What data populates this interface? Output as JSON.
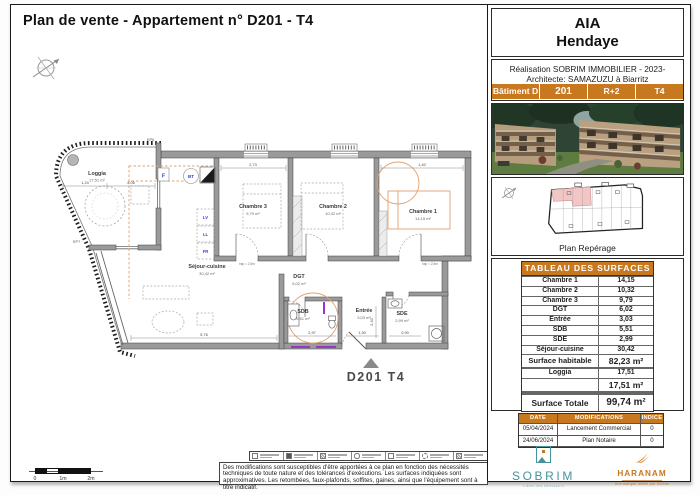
{
  "sheet": {
    "title": "Plan de vente - Appartement n° D201 - T4"
  },
  "panel": {
    "project_name": "AIA",
    "project_city": "Hendaye",
    "credit_line1": "Réalisation SOBRIM IMMOBILIER - 2023-",
    "credit_line2": "Architecte: SAMAZUZU à Biarritz",
    "unit_bar": {
      "building": "Bâtiment D",
      "number": "201",
      "floor": "R+2",
      "type": "T4"
    },
    "reperage_label": "Plan Repérage",
    "surfaces": {
      "header": "TABLEAU DES SURFACES",
      "rows": [
        {
          "label": "Chambre 1",
          "value": "14,15"
        },
        {
          "label": "Chambre 2",
          "value": "10,32"
        },
        {
          "label": "Chambre 3",
          "value": "9,79"
        },
        {
          "label": "DGT",
          "value": "6,02"
        },
        {
          "label": "Entrée",
          "value": "3,03"
        },
        {
          "label": "SDB",
          "value": "5,51"
        },
        {
          "label": "SDE",
          "value": "2,99"
        },
        {
          "label": "Séjour-cuisine",
          "value": "30,42"
        }
      ],
      "habitable_label": "Surface habitable",
      "habitable_value": "82,23 m²",
      "loggia_label": "Loggia",
      "loggia_value": "17,51",
      "loggia_total": "17,51 m²",
      "total_label": "Surface Totale",
      "total_value": "99,74 m²"
    },
    "revisions": {
      "headers": [
        "DATE",
        "MODIFICATIONS",
        "INDICE"
      ],
      "rows": [
        {
          "date": "05/04/2024",
          "modification": "Lancement Commercial",
          "indice": "0"
        },
        {
          "date": "24/06/2024",
          "modification": "Plan Notaire",
          "indice": "0"
        }
      ]
    },
    "logos": {
      "sobrim_name": "SOBRIM",
      "sobrim_tagline": "L'âme des bâtisseurs",
      "haranam_name": "HARANAM",
      "haranam_tagline": "Une marque initiée par Sobrim"
    }
  },
  "plan": {
    "unit_label": "D201 T4",
    "rooms": [
      {
        "name": "Loggia",
        "area": "17,51 m²"
      },
      {
        "name": "Chambre 3",
        "area": "9,79 m²"
      },
      {
        "name": "Chambre 2",
        "area": "10,32 m²"
      },
      {
        "name": "Chambre 1",
        "area": "14,15 m²"
      },
      {
        "name": "Séjour-cuisine",
        "area": "30,42 m²"
      },
      {
        "name": "DGT",
        "area": "6,02 m²"
      },
      {
        "name": "SDB",
        "area": "5,51 m²"
      },
      {
        "name": "Entrée",
        "area": "3,03 m²"
      },
      {
        "name": "SDE",
        "area": "2,99 m²"
      }
    ],
    "annotations": {
      "ep6": "EP6",
      "ep7": "EP7",
      "bt": "BT",
      "f": "F",
      "lv": "LV",
      "ll": "LL",
      "fr": "FR",
      "hsp1": "hsp = 2,5m",
      "hsp2": "hsp = 2,5m"
    },
    "dims": {
      "d1": "1,24",
      "d2": "2,06",
      "d3": "2,73",
      "d4": "1,40",
      "d5": "5,76",
      "d6": "2,97",
      "d7": "1,30",
      "d8": "0,90",
      "d9": "2,40"
    }
  },
  "footer": {
    "scale_0": "0",
    "scale_1": "1m",
    "scale_2": "2m",
    "disclaimer": "Des modifications sont susceptibles d'être apportées à ce plan en fonction des nécessités techniques de toute nature et des tolérances d'exécutions. Les surfaces indiquées sont approximatives. Les retombées, faux-plafonds, soffites, gaines, ainsi que l'équipement sont à titre indicatif."
  },
  "colors": {
    "accent_orange": "#C8781F",
    "sobrim_teal": "#47929B",
    "reperage_pink": "#F2C6C4",
    "wall_gray": "#9A9A9A",
    "plumbing_purple": "#9A35C8",
    "furniture_orange": "#E2A070"
  }
}
